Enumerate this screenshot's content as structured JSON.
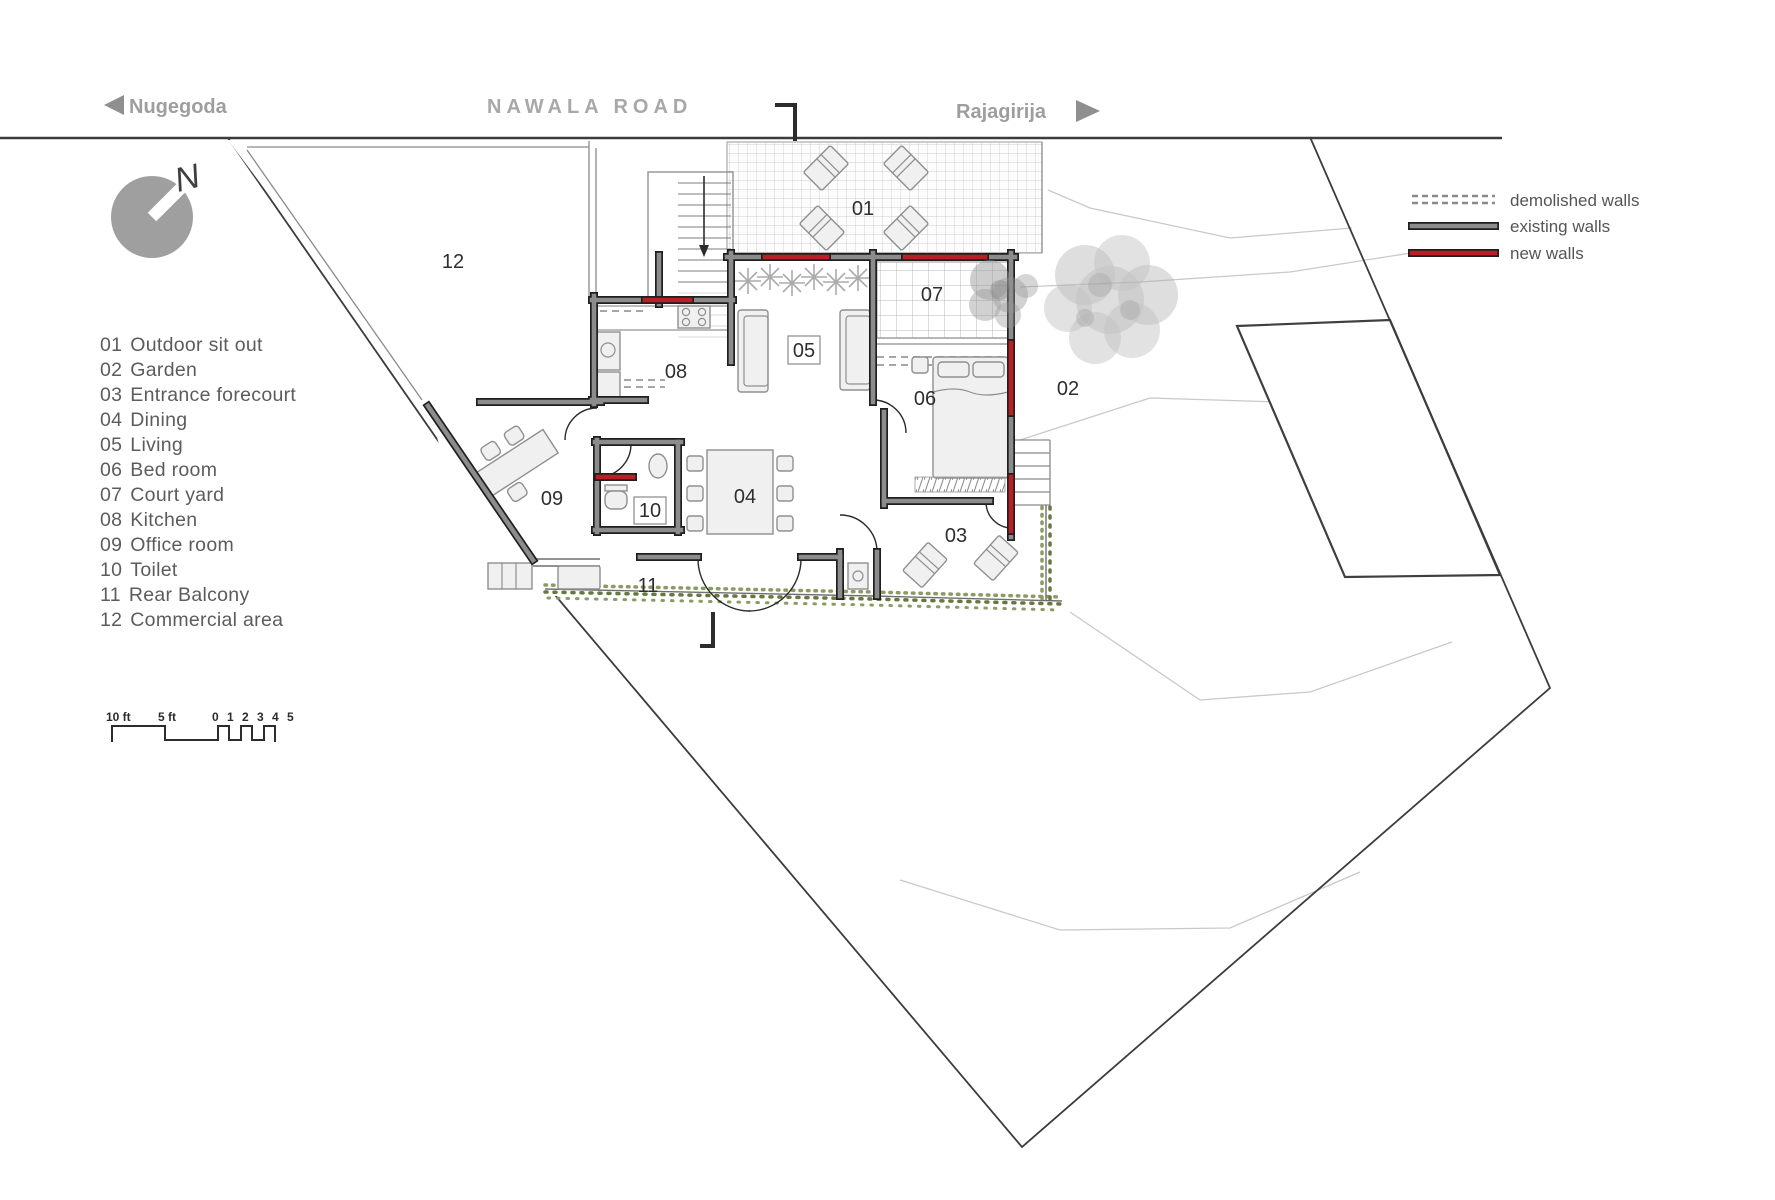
{
  "road": {
    "name": "NAWALA  ROAD",
    "left_direction": "Nugegoda",
    "right_direction": "Rajagirija"
  },
  "compass": {
    "label": "N"
  },
  "legend": {
    "items": [
      {
        "label": "demolished walls",
        "style": "demolished"
      },
      {
        "label": "existing walls",
        "style": "existing"
      },
      {
        "label": "new walls",
        "style": "new"
      }
    ]
  },
  "rooms": [
    {
      "num": "01",
      "name": "Outdoor sit out"
    },
    {
      "num": "02",
      "name": "Garden"
    },
    {
      "num": "03",
      "name": "Entrance forecourt"
    },
    {
      "num": "04",
      "name": "Dining"
    },
    {
      "num": "05",
      "name": "Living"
    },
    {
      "num": "06",
      "name": "Bed room"
    },
    {
      "num": "07",
      "name": "Court yard"
    },
    {
      "num": "08",
      "name": "Kitchen"
    },
    {
      "num": "09",
      "name": "Office room"
    },
    {
      "num": "10",
      "name": "Toilet"
    },
    {
      "num": "11",
      "name": "Rear Balcony"
    },
    {
      "num": "12",
      "name": "Commercial area"
    }
  ],
  "scale_bar": {
    "label_10": "10 ft",
    "label_5": "5 ft",
    "label_units": "0 1 2 3 4 5"
  },
  "colors": {
    "new_wall": "#b92025",
    "existing_wall": "#8c8c8c",
    "wall_edge": "#1f1f1f",
    "hedge_green": "#8a9c63",
    "hedge_green_dark": "#66783f",
    "road_text": "#9e9e9e",
    "list_text": "#5c5c5c",
    "label_text": "#2e2e2e"
  }
}
